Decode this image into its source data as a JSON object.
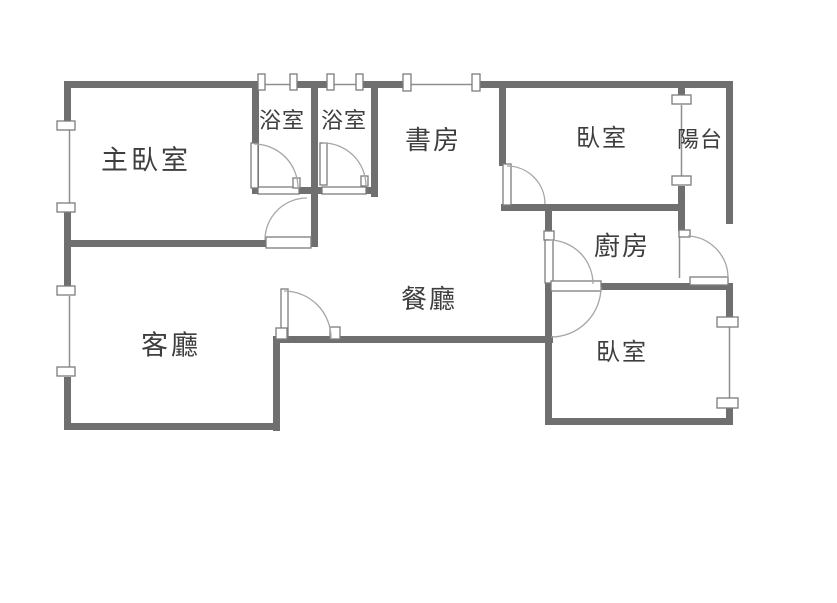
{
  "floorplan": {
    "type": "apartment-floor-plan",
    "colors": {
      "wall": "#6f6f6f",
      "window_line": "#8f8f8f",
      "door_arc": "#a6a6a6",
      "fixture_border": "#7c7c7c",
      "label_text": "#3e3e3e",
      "background": "#ffffff"
    },
    "rooms": [
      {
        "id": "master-bedroom",
        "label": "主臥室"
      },
      {
        "id": "bathroom-1",
        "label": "浴室"
      },
      {
        "id": "bathroom-2",
        "label": "浴室"
      },
      {
        "id": "study",
        "label": "書房"
      },
      {
        "id": "bedroom-top",
        "label": "臥室"
      },
      {
        "id": "balcony",
        "label": "陽台"
      },
      {
        "id": "kitchen",
        "label": "廚房"
      },
      {
        "id": "dining-room",
        "label": "餐廳"
      },
      {
        "id": "living-room",
        "label": "客廳"
      },
      {
        "id": "bedroom-bottom",
        "label": "臥室"
      }
    ]
  }
}
